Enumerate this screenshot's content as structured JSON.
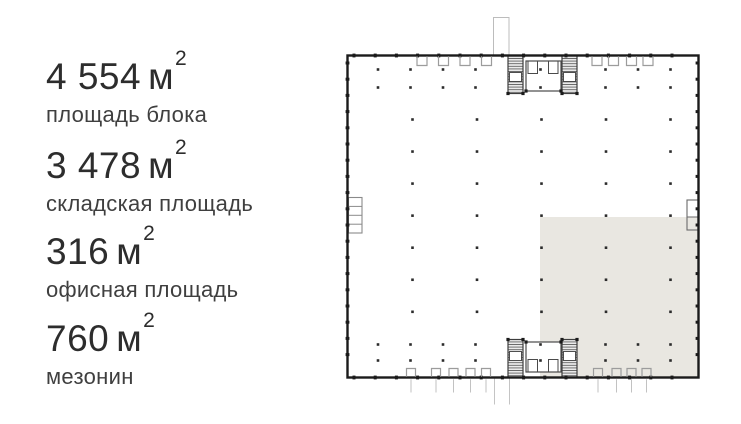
{
  "stats": [
    {
      "value": "4 554",
      "unit": "м",
      "exp": "2",
      "label": "площадь блока"
    },
    {
      "value": "3 478",
      "unit": "м",
      "exp": "2",
      "label": "складская площадь"
    },
    {
      "value": "316",
      "unit": "м",
      "exp": "2",
      "label": "офисная площадь"
    },
    {
      "value": "760",
      "unit": "м",
      "exp": "2",
      "label": "мезонин"
    }
  ],
  "floorplan": {
    "name": "warehouse-block-plan",
    "highlight_color": "#e9e7e1",
    "wall_color": "#1b1b1b",
    "detail_line_color": "#9c9c9c",
    "light_line_color": "#c2c2c2",
    "core_line_color": "#3d3d3d",
    "dot_color": "#2b2b2b"
  }
}
